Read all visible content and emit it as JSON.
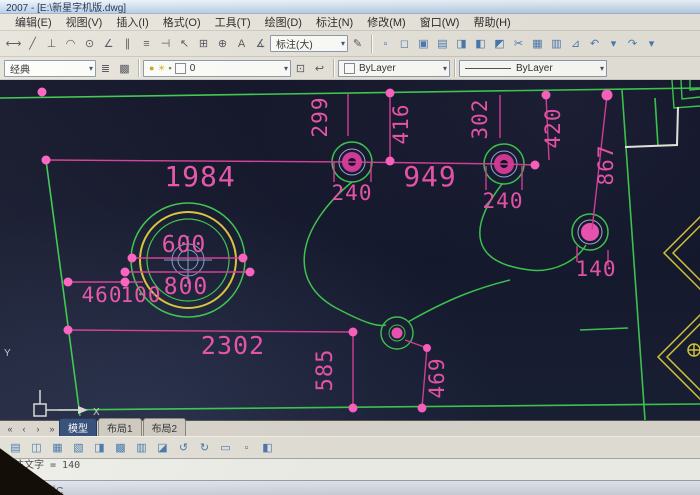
{
  "window": {
    "title": "2007 - [E:\\新星字机版.dwg]"
  },
  "menu": {
    "items": [
      "编辑(E)",
      "视图(V)",
      "插入(I)",
      "格式(O)",
      "工具(T)",
      "绘图(D)",
      "标注(N)",
      "修改(M)",
      "窗口(W)",
      "帮助(H)"
    ]
  },
  "ui": {
    "caret_glyph": "▾"
  },
  "toolbars": {
    "dimension": {
      "icons": [
        {
          "name": "dim-linear-icon",
          "glyph": "⟷"
        },
        {
          "name": "dim-aligned-icon",
          "glyph": "╱"
        },
        {
          "name": "dim-ordinate-icon",
          "glyph": "⊥"
        },
        {
          "name": "dim-radius-icon",
          "glyph": "◠"
        },
        {
          "name": "dim-diameter-icon",
          "glyph": "⊙"
        },
        {
          "name": "dim-angular-icon",
          "glyph": "∠"
        },
        {
          "name": "dim-quick-icon",
          "glyph": "∥"
        },
        {
          "name": "dim-baseline-icon",
          "glyph": "≡"
        },
        {
          "name": "dim-continue-icon",
          "glyph": "⊣"
        },
        {
          "name": "dim-leader-icon",
          "glyph": "↖"
        },
        {
          "name": "dim-tolerance-icon",
          "glyph": "⊞"
        },
        {
          "name": "dim-center-mark-icon",
          "glyph": "⊕"
        },
        {
          "name": "dim-edit-icon",
          "glyph": "A"
        },
        {
          "name": "dim-text-edit-icon",
          "glyph": "∡"
        }
      ],
      "style_combo_value": "标注(大)",
      "update_icon": {
        "name": "dim-update-icon",
        "glyph": "✎"
      }
    },
    "standard": {
      "icons": [
        {
          "name": "new-icon",
          "glyph": "▫"
        },
        {
          "name": "open-icon",
          "glyph": "◻"
        },
        {
          "name": "save-icon",
          "glyph": "▣"
        },
        {
          "name": "plot-icon",
          "glyph": "▤"
        },
        {
          "name": "plot-preview-icon",
          "glyph": "◨"
        },
        {
          "name": "publish-icon",
          "glyph": "◧"
        },
        {
          "name": "dwf-icon",
          "glyph": "◩"
        },
        {
          "name": "cut-icon",
          "glyph": "✂"
        },
        {
          "name": "copy-icon",
          "glyph": "▦"
        },
        {
          "name": "paste-icon",
          "glyph": "▥"
        },
        {
          "name": "match-properties-icon",
          "glyph": "⊿"
        },
        {
          "name": "undo-icon",
          "glyph": "↶"
        },
        {
          "name": "undo-caret-icon",
          "glyph": "▾"
        },
        {
          "name": "redo-icon",
          "glyph": "↷"
        },
        {
          "name": "redo-caret-icon",
          "glyph": "▾"
        }
      ]
    },
    "layers": {
      "workspace_combo_value": "经典",
      "left_icons": [
        {
          "name": "layer-properties-icon",
          "glyph": "≣"
        },
        {
          "name": "layer-states-icon",
          "glyph": "▩"
        }
      ],
      "layer_combo": {
        "bulb_icon": "●",
        "freeze_icon": "☀",
        "lock_icon": "▪",
        "layer_name": "0"
      },
      "right_icons": [
        {
          "name": "make-object-layer-icon",
          "glyph": "⊡"
        },
        {
          "name": "layer-previous-icon",
          "glyph": "↩"
        }
      ],
      "color_combo_value": "ByLayer",
      "linetype_combo_value": "ByLayer"
    }
  },
  "drawing": {
    "dims": {
      "v1984": "1984",
      "v949": "949",
      "v240a": "240",
      "v240b": "240",
      "v299": "299",
      "v416": "416",
      "v302": "302",
      "v420": "420",
      "v867": "867",
      "v140": "140",
      "v600": "600",
      "v800": "800",
      "v460": "460",
      "v100": "100",
      "v2302": "2302",
      "v585": "585",
      "v469": "469"
    },
    "ucs": {
      "x_label": "X",
      "y_label": "Y"
    },
    "colors": {
      "dim_magenta": "#e84da8",
      "dot_pink": "#ff63c2",
      "wall_green": "#3ec94f",
      "ornament_yellow": "#d9c93a",
      "background": "#12142b",
      "crosshair_blue": "#7fa3c9"
    }
  },
  "tabs": {
    "nav": [
      {
        "name": "tab-scroll-first-icon",
        "glyph": "«"
      },
      {
        "name": "tab-scroll-prev-icon",
        "glyph": "‹"
      },
      {
        "name": "tab-scroll-next-icon",
        "glyph": "›"
      },
      {
        "name": "tab-scroll-last-icon",
        "glyph": "»"
      }
    ],
    "items": [
      {
        "label": "模型"
      },
      {
        "label": "布局1"
      },
      {
        "label": "布局2"
      }
    ]
  },
  "bottom_toolbar": {
    "icons": [
      {
        "name": "bottom-tool-1-icon",
        "glyph": "▤"
      },
      {
        "name": "bottom-tool-2-icon",
        "glyph": "◫"
      },
      {
        "name": "bottom-tool-3-icon",
        "glyph": "▦"
      },
      {
        "name": "bottom-tool-4-icon",
        "glyph": "▧"
      },
      {
        "name": "bottom-tool-5-icon",
        "glyph": "◨"
      },
      {
        "name": "bottom-tool-6-icon",
        "glyph": "▩"
      },
      {
        "name": "bottom-tool-7-icon",
        "glyph": "▥"
      },
      {
        "name": "bottom-tool-8-icon",
        "glyph": "◪"
      },
      {
        "name": "bottom-tool-9-icon",
        "glyph": "↺"
      },
      {
        "name": "bottom-tool-10-icon",
        "glyph": "↻"
      },
      {
        "name": "bottom-tool-11-icon",
        "glyph": "▭"
      },
      {
        "name": "bottom-tool-12-icon",
        "glyph": "▫"
      },
      {
        "name": "bottom-tool-13-icon",
        "glyph": "◧"
      }
    ]
  },
  "command": {
    "line1": "标注文字 = 140",
    "line2": "命令:",
    "status_text": "经典工具栏C"
  }
}
